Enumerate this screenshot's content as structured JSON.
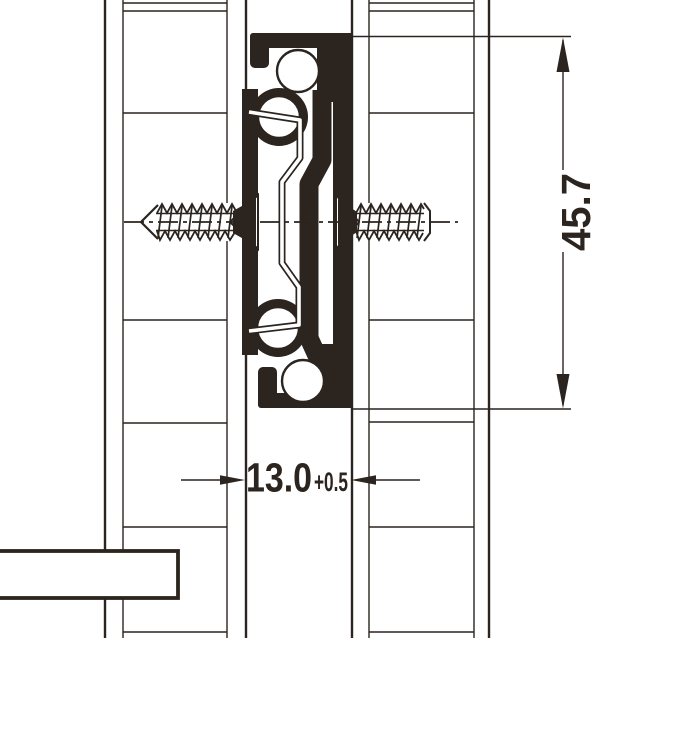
{
  "drawing": {
    "dimensions": {
      "slide_height": {
        "label": "45.7"
      },
      "mounting_gap": {
        "label": "13.0",
        "tolerance": "+0.5"
      }
    },
    "colors": {
      "ink": "#2b241f",
      "background": "#ffffff"
    }
  }
}
